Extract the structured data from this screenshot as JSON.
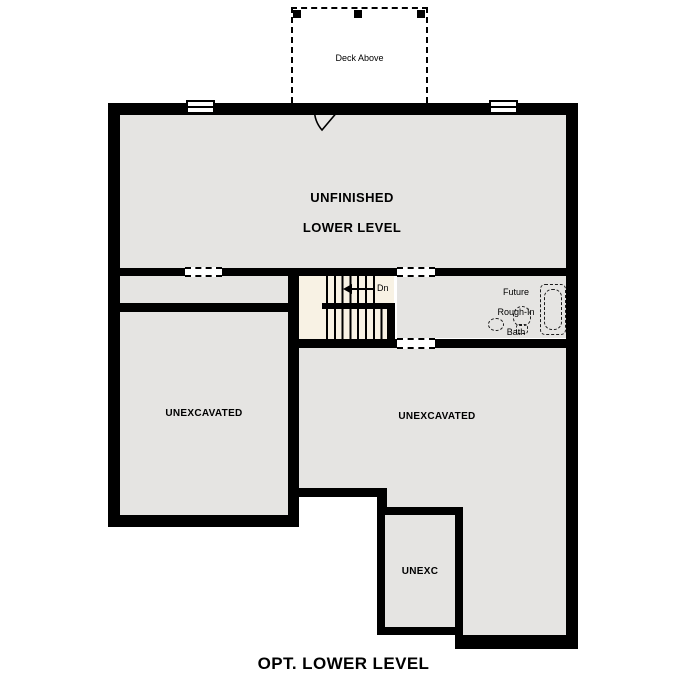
{
  "plan_title": "OPT. LOWER LEVEL",
  "deck": {
    "label": "Deck Above"
  },
  "rooms": {
    "unfinished": {
      "line1": "UNFINISHED",
      "line2": "LOWER LEVEL"
    },
    "unexcavated_left": {
      "label": "UNEXCAVATED"
    },
    "unexcavated_right": {
      "label": "UNEXCAVATED"
    },
    "unexc": {
      "label": "UNEXC"
    }
  },
  "stairs": {
    "down_label": "Dn"
  },
  "bath": {
    "line1": "Future",
    "line2": "Rough-In",
    "line3": "Bath"
  },
  "colors": {
    "wall": "#000000",
    "room_fill": "#e5e4e2",
    "stair_fill": "#f8f2e4",
    "background": "#ffffff"
  }
}
